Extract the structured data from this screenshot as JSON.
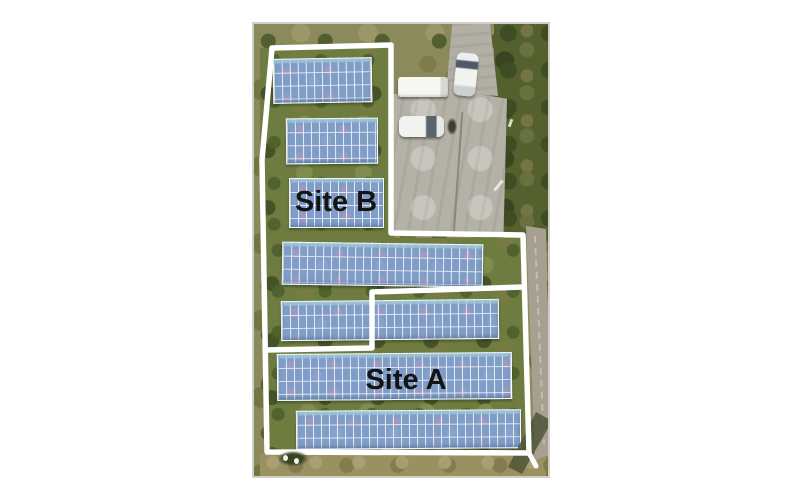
{
  "page": {
    "background": "#ffffff"
  },
  "figure": {
    "description": "Aerial photograph of a ground-mounted solar PV plant with white site boundary outlines",
    "site_a_label": "Site A",
    "site_b_label": "Site B",
    "label_color": "#141414",
    "boundary_color": "#ffffff",
    "panel_color": "#7f9dc6",
    "panel_row_count": 7,
    "vehicles": [
      {
        "name": "box-truck",
        "color": "#f7f7f4"
      },
      {
        "name": "white-sedan",
        "color": "#f2f2ef"
      },
      {
        "name": "white-car",
        "color": "#eceff0"
      }
    ]
  }
}
